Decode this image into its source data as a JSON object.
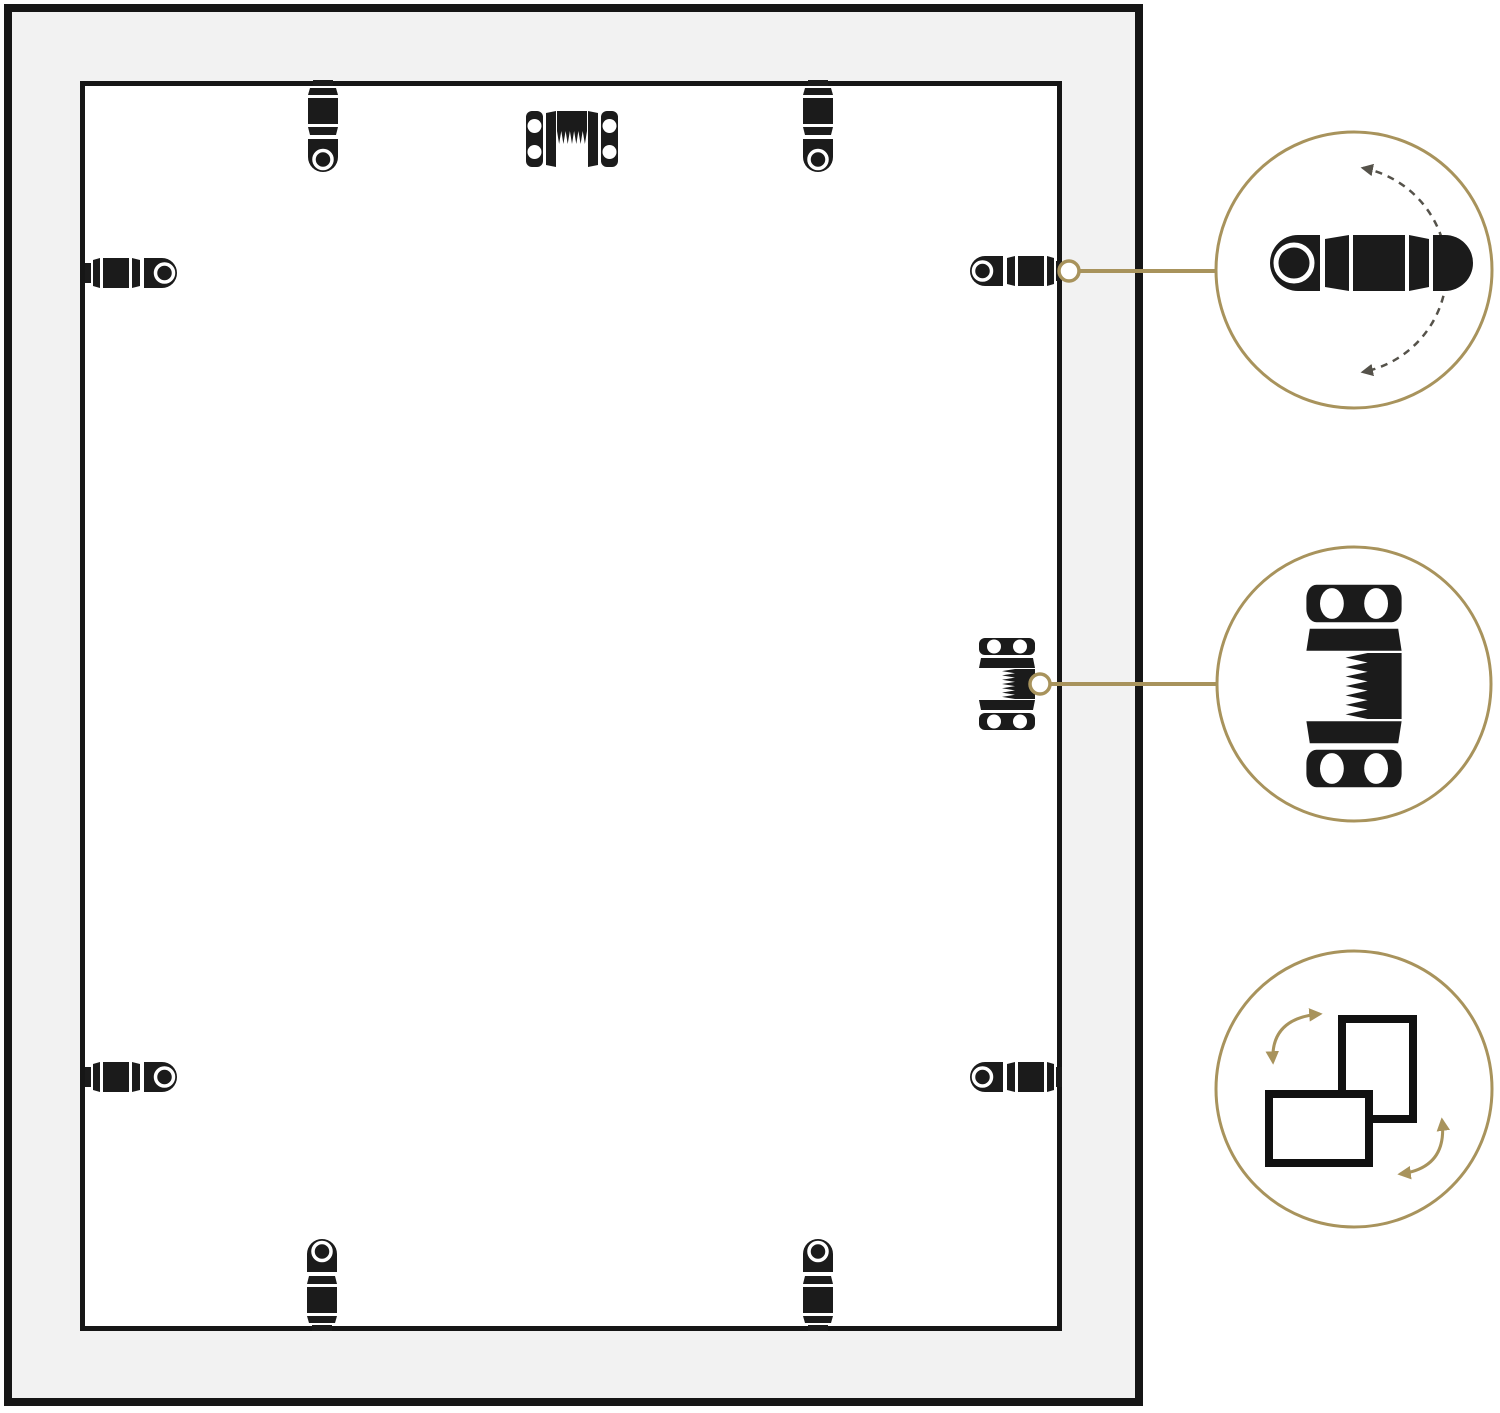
{
  "colors": {
    "background": "#ffffff",
    "frame_border_black": "#161616",
    "frame_face_gray": "#f2f2f2",
    "panel_fill": "#ffffff",
    "hardware_black": "#1b1b1b",
    "accent_gold": "#a8935c",
    "rotation_dash_gray": "#55524a"
  },
  "frame_back": {
    "turn_buttons": [
      {
        "id": "turn-button-top-left",
        "edge": "top"
      },
      {
        "id": "turn-button-top-right",
        "edge": "top"
      },
      {
        "id": "turn-button-left-upper",
        "edge": "left"
      },
      {
        "id": "turn-button-left-lower",
        "edge": "left"
      },
      {
        "id": "turn-button-right-upper",
        "edge": "right"
      },
      {
        "id": "turn-button-right-lower",
        "edge": "right"
      },
      {
        "id": "turn-button-bottom-left",
        "edge": "bottom"
      },
      {
        "id": "turn-button-bottom-right",
        "edge": "bottom"
      }
    ],
    "spring_clips": [
      {
        "id": "spring-clip-top-center",
        "edge": "top"
      },
      {
        "id": "spring-clip-right-middle",
        "edge": "right"
      }
    ]
  },
  "callouts": [
    {
      "id": "callout-turn-button-rotation",
      "icon": "turn-button-rotate-icon",
      "shows": "rotating turn button",
      "connected_to": "turn-button-right-upper"
    },
    {
      "id": "callout-spring-clip",
      "icon": "spring-clip-icon",
      "shows": "spring clip detail",
      "connected_to": "spring-clip-right-middle"
    },
    {
      "id": "callout-orientation",
      "icon": "portrait-landscape-icon",
      "shows": "portrait or landscape hanging"
    }
  ]
}
